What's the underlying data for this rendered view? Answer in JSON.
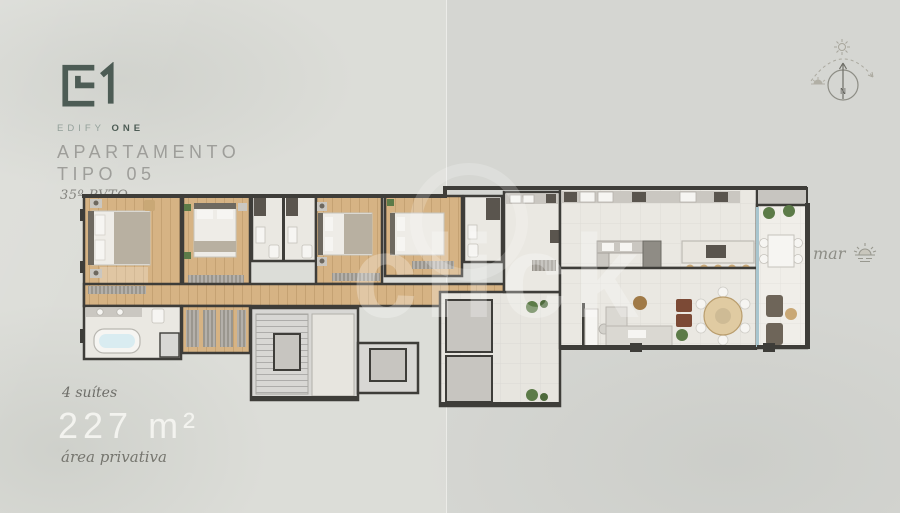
{
  "brand": {
    "logo_mark": "E1",
    "name_light": "EDIFY",
    "name_bold": "ONE"
  },
  "header": {
    "title_line1": "APARTAMENTO",
    "title_line2": "TIPO 05",
    "subtitle": "35º PVTO"
  },
  "stats": {
    "suites": "4 suítes",
    "area": "227 m²",
    "area_label": "área privativa"
  },
  "compass": {
    "label": "N"
  },
  "sea": {
    "label": "mar"
  },
  "watermark": {
    "text": "click"
  },
  "colors": {
    "bg": "#dcddd8",
    "wall": "#3e3d39",
    "wood": "#d6b384",
    "tile": "#eae8e2",
    "tile_warm": "#e7e5df",
    "tile_light": "#f0eee9",
    "stone": "#d8d7d4",
    "concrete": "#c7c5c0",
    "cabinet": "#cac7c1",
    "fixture": "#f6f5f2",
    "module_dark": "#5a554e",
    "bed_white": "#eeece7",
    "bed_gray": "#b8b0a1",
    "headboard": "#6e6960",
    "glass": "#a8c5ce",
    "plant": "#5c7b48",
    "rust": "#7c4a36",
    "tan": "#c9a876",
    "marble": "#e9e6df",
    "brand": "#4d5c55",
    "brand_light": "#93a09a",
    "title_text": "#9e9e9a",
    "area_text": "#f3f3ef"
  }
}
